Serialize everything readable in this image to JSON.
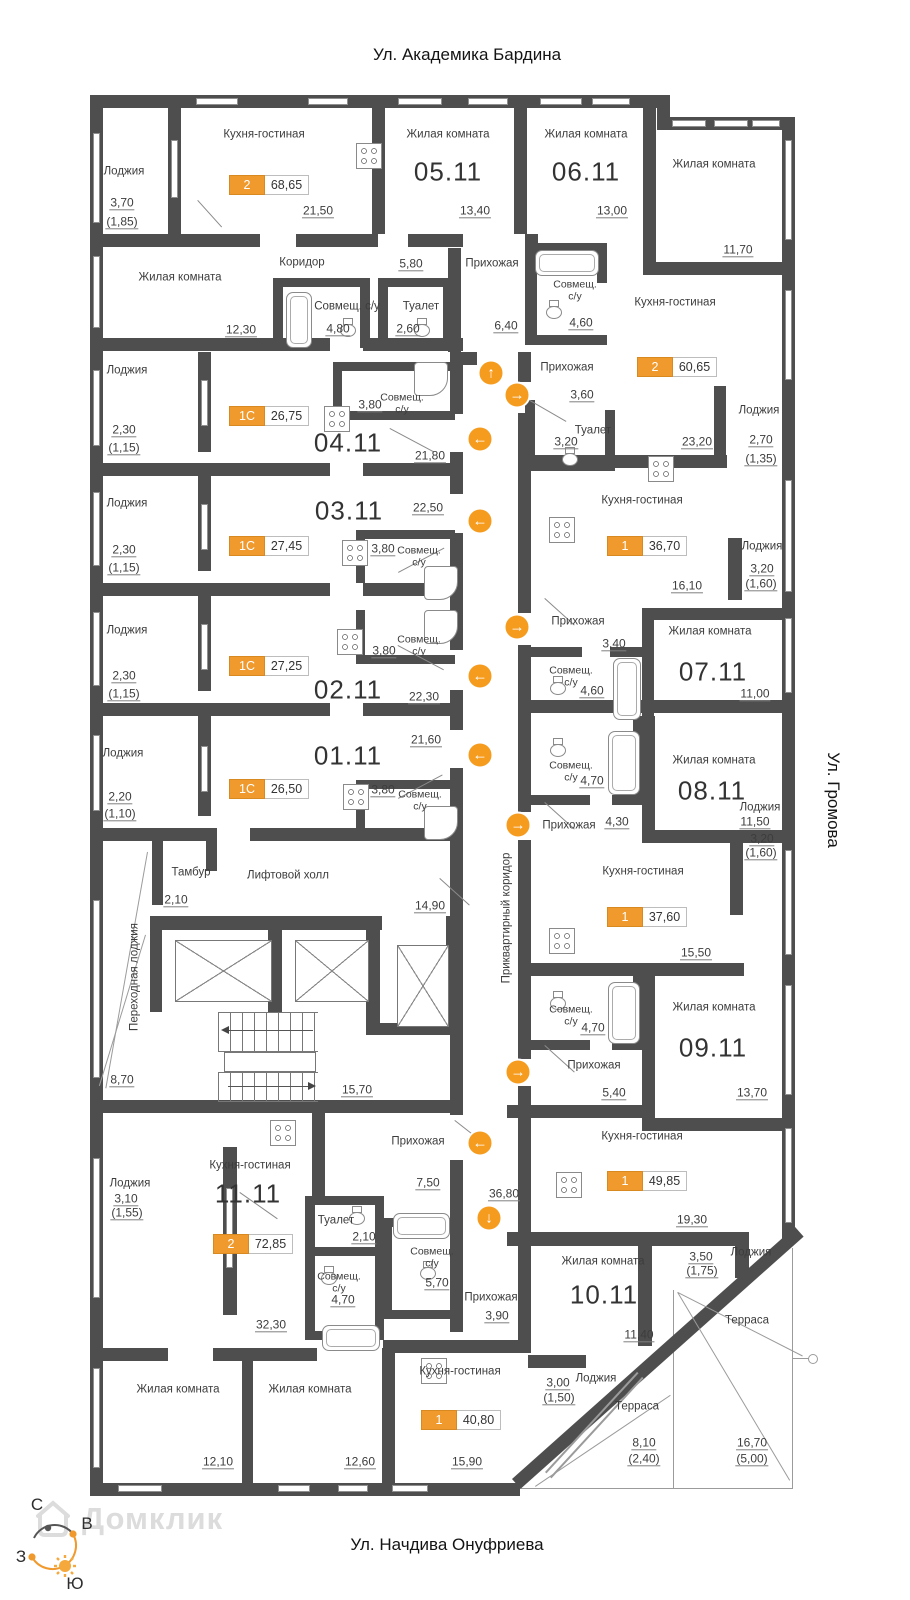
{
  "streets": {
    "top": "Ул. Академика Бардина",
    "right": "Ул. Громова",
    "bottom": "Ул. Начдива Онуфриева"
  },
  "compass": {
    "north": "С",
    "east": "В",
    "west": "З",
    "south": "Ю"
  },
  "watermark": {
    "brand": "Домклик"
  },
  "colors": {
    "wall": "#4E4E4E",
    "accent": "#F0992D",
    "arrow": "#F59B1E"
  },
  "plan": {
    "room_labels": [
      {
        "t": "Лоджия",
        "x": 124,
        "y": 172
      },
      {
        "t": "Кухня-гостиная",
        "x": 264,
        "y": 135
      },
      {
        "t": "Жилая комната",
        "x": 448,
        "y": 135
      },
      {
        "t": "Жилая комната",
        "x": 586,
        "y": 135
      },
      {
        "t": "Жилая комната",
        "x": 714,
        "y": 165
      },
      {
        "t": "Жилая комната",
        "x": 180,
        "y": 278
      },
      {
        "t": "Коридор",
        "x": 302,
        "y": 263
      },
      {
        "t": "Прихожая",
        "x": 492,
        "y": 264
      },
      {
        "t": "Совмещ. с/у",
        "x": 347,
        "y": 307
      },
      {
        "t": "Туалет",
        "x": 421,
        "y": 307
      },
      {
        "t": "Совмещ.\nс/у",
        "x": 575,
        "y": 291,
        "s": 10.5
      },
      {
        "t": "Кухня-гостиная",
        "x": 675,
        "y": 303
      },
      {
        "t": "Прихожая",
        "x": 567,
        "y": 368
      },
      {
        "t": "Туалет",
        "x": 593,
        "y": 431
      },
      {
        "t": "Лоджия",
        "x": 759,
        "y": 411
      },
      {
        "t": "Лоджия",
        "x": 127,
        "y": 371
      },
      {
        "t": "Совмещ.\nс/у",
        "x": 402,
        "y": 404,
        "s": 10.5
      },
      {
        "t": "Лоджия",
        "x": 127,
        "y": 504
      },
      {
        "t": "Совмещ.\nс/у",
        "x": 419,
        "y": 557,
        "s": 10.5
      },
      {
        "t": "Лоджия",
        "x": 127,
        "y": 631
      },
      {
        "t": "Совмещ.\nс/у",
        "x": 419,
        "y": 646,
        "s": 10.5
      },
      {
        "t": "Кухня-гостиная",
        "x": 642,
        "y": 501
      },
      {
        "t": "Лоджия",
        "x": 762,
        "y": 547
      },
      {
        "t": "Прихожая",
        "x": 578,
        "y": 622
      },
      {
        "t": "Совмещ.\nс/у",
        "x": 571,
        "y": 677,
        "s": 10.5
      },
      {
        "t": "Жилая комната",
        "x": 710,
        "y": 632
      },
      {
        "t": "Лоджия",
        "x": 123,
        "y": 754
      },
      {
        "t": "Совмещ.\nс/у",
        "x": 420,
        "y": 801,
        "s": 10.5
      },
      {
        "t": "Тамбур",
        "x": 191,
        "y": 873
      },
      {
        "t": "Лифтовой холл",
        "x": 288,
        "y": 876
      },
      {
        "t": "Совмещ.\nс/у",
        "x": 571,
        "y": 772,
        "s": 10.5
      },
      {
        "t": "Прихожая",
        "x": 569,
        "y": 826
      },
      {
        "t": "Жилая комната",
        "x": 714,
        "y": 761
      },
      {
        "t": "Кухня-гостиная",
        "x": 643,
        "y": 872
      },
      {
        "t": "Лоджия",
        "x": 760,
        "y": 808
      },
      {
        "t": "Переходная лоджия",
        "x": 135,
        "y": 977,
        "v": true
      },
      {
        "t": "Приквартирный коридор",
        "x": 507,
        "y": 918,
        "v": true
      },
      {
        "t": "Совмещ.\nс/у",
        "x": 571,
        "y": 1016,
        "s": 10.5
      },
      {
        "t": "Прихожая",
        "x": 594,
        "y": 1066
      },
      {
        "t": "Жилая комната",
        "x": 714,
        "y": 1008
      },
      {
        "t": "Кухня-гостиная",
        "x": 642,
        "y": 1137
      },
      {
        "t": "Прихожая",
        "x": 418,
        "y": 1142
      },
      {
        "t": "Кухня-гостиная",
        "x": 250,
        "y": 1166
      },
      {
        "t": "Лоджия",
        "x": 130,
        "y": 1184
      },
      {
        "t": "Туалет",
        "x": 336,
        "y": 1221
      },
      {
        "t": "Совмещ.\nс/у",
        "x": 432,
        "y": 1258,
        "s": 10.5
      },
      {
        "t": "Совмещ.\nс/у",
        "x": 339,
        "y": 1283,
        "s": 10.5
      },
      {
        "t": "Прихожая",
        "x": 491,
        "y": 1298
      },
      {
        "t": "Жилая комната",
        "x": 603,
        "y": 1262
      },
      {
        "t": "Лоджия",
        "x": 751,
        "y": 1253
      },
      {
        "t": "Терраса",
        "x": 747,
        "y": 1321
      },
      {
        "t": "Лоджия",
        "x": 596,
        "y": 1379
      },
      {
        "t": "Терраса",
        "x": 637,
        "y": 1407
      },
      {
        "t": "Жилая комната",
        "x": 178,
        "y": 1390
      },
      {
        "t": "Жилая комната",
        "x": 310,
        "y": 1390
      },
      {
        "t": "Кухня-гостиная",
        "x": 460,
        "y": 1372
      }
    ],
    "apartment_numbers": [
      {
        "t": "05.11",
        "x": 448,
        "y": 172
      },
      {
        "t": "06.11",
        "x": 586,
        "y": 172
      },
      {
        "t": "04.11",
        "x": 348,
        "y": 443
      },
      {
        "t": "03.11",
        "x": 349,
        "y": 511
      },
      {
        "t": "02.11",
        "x": 348,
        "y": 690
      },
      {
        "t": "01.11",
        "x": 348,
        "y": 756
      },
      {
        "t": "07.11",
        "x": 713,
        "y": 672
      },
      {
        "t": "08.11",
        "x": 712,
        "y": 791
      },
      {
        "t": "09.11",
        "x": 713,
        "y": 1048
      },
      {
        "t": "10.11",
        "x": 604,
        "y": 1295
      },
      {
        "t": "11.11",
        "x": 248,
        "y": 1194
      }
    ],
    "dimensions": [
      {
        "t": "3,70",
        "x": 122,
        "y": 203
      },
      {
        "t": "(1,85)",
        "x": 122,
        "y": 222
      },
      {
        "t": "21,50",
        "x": 318,
        "y": 211
      },
      {
        "t": "13,40",
        "x": 475,
        "y": 211
      },
      {
        "t": "13,00",
        "x": 612,
        "y": 211
      },
      {
        "t": "11,70",
        "x": 738,
        "y": 250
      },
      {
        "t": "12,30",
        "x": 241,
        "y": 330
      },
      {
        "t": "5,80",
        "x": 411,
        "y": 264
      },
      {
        "t": "4,80",
        "x": 338,
        "y": 329
      },
      {
        "t": "2,60",
        "x": 408,
        "y": 329
      },
      {
        "t": "6,40",
        "x": 506,
        "y": 326
      },
      {
        "t": "4,60",
        "x": 581,
        "y": 323
      },
      {
        "t": "3,60",
        "x": 582,
        "y": 395
      },
      {
        "t": "3,20",
        "x": 566,
        "y": 442
      },
      {
        "t": "23,20",
        "x": 697,
        "y": 442
      },
      {
        "t": "2,70",
        "x": 761,
        "y": 440
      },
      {
        "t": "(1,35)",
        "x": 761,
        "y": 459
      },
      {
        "t": "2,30",
        "x": 124,
        "y": 430
      },
      {
        "t": "(1,15)",
        "x": 124,
        "y": 448
      },
      {
        "t": "21,80",
        "x": 430,
        "y": 456
      },
      {
        "t": "3,80",
        "x": 370,
        "y": 405
      },
      {
        "t": "22,50",
        "x": 428,
        "y": 508
      },
      {
        "t": "3,80",
        "x": 383,
        "y": 549
      },
      {
        "t": "2,30",
        "x": 124,
        "y": 550
      },
      {
        "t": "(1,15)",
        "x": 124,
        "y": 568
      },
      {
        "t": "16,10",
        "x": 687,
        "y": 586
      },
      {
        "t": "3,20",
        "x": 762,
        "y": 569
      },
      {
        "t": "(1,60)",
        "x": 761,
        "y": 584
      },
      {
        "t": "3,40",
        "x": 614,
        "y": 644
      },
      {
        "t": "4,60",
        "x": 592,
        "y": 691
      },
      {
        "t": "11,00",
        "x": 755,
        "y": 694
      },
      {
        "t": "2,30",
        "x": 124,
        "y": 676
      },
      {
        "t": "(1,15)",
        "x": 124,
        "y": 694
      },
      {
        "t": "3,80",
        "x": 384,
        "y": 651
      },
      {
        "t": "22,30",
        "x": 424,
        "y": 697
      },
      {
        "t": "21,60",
        "x": 426,
        "y": 740
      },
      {
        "t": "2,20",
        "x": 120,
        "y": 797
      },
      {
        "t": "(1,10)",
        "x": 120,
        "y": 814
      },
      {
        "t": "3,80",
        "x": 383,
        "y": 790
      },
      {
        "t": "4,70",
        "x": 592,
        "y": 781
      },
      {
        "t": "4,30",
        "x": 617,
        "y": 822
      },
      {
        "t": "11,50",
        "x": 755,
        "y": 822
      },
      {
        "t": "15,50",
        "x": 696,
        "y": 953
      },
      {
        "t": "3,20",
        "x": 762,
        "y": 839
      },
      {
        "t": "(1,60)",
        "x": 761,
        "y": 853
      },
      {
        "t": "2,10",
        "x": 176,
        "y": 900
      },
      {
        "t": "14,90",
        "x": 430,
        "y": 906
      },
      {
        "t": "8,70",
        "x": 122,
        "y": 1080
      },
      {
        "t": "15,70",
        "x": 357,
        "y": 1090
      },
      {
        "t": "4,70",
        "x": 593,
        "y": 1028
      },
      {
        "t": "5,40",
        "x": 614,
        "y": 1093
      },
      {
        "t": "13,70",
        "x": 752,
        "y": 1093
      },
      {
        "t": "7,50",
        "x": 428,
        "y": 1183
      },
      {
        "t": "36,80",
        "x": 504,
        "y": 1194
      },
      {
        "t": "3,10",
        "x": 126,
        "y": 1199
      },
      {
        "t": "(1,55)",
        "x": 127,
        "y": 1213
      },
      {
        "t": "2,10",
        "x": 364,
        "y": 1237
      },
      {
        "t": "4,70",
        "x": 343,
        "y": 1300
      },
      {
        "t": "5,70",
        "x": 437,
        "y": 1283
      },
      {
        "t": "3,90",
        "x": 497,
        "y": 1316
      },
      {
        "t": "32,30",
        "x": 271,
        "y": 1325
      },
      {
        "t": "19,30",
        "x": 692,
        "y": 1220
      },
      {
        "t": "11,40",
        "x": 639,
        "y": 1335
      },
      {
        "t": "3,50",
        "x": 701,
        "y": 1257
      },
      {
        "t": "(1,75)",
        "x": 702,
        "y": 1271
      },
      {
        "t": "3,00",
        "x": 558,
        "y": 1383
      },
      {
        "t": "(1,50)",
        "x": 559,
        "y": 1398
      },
      {
        "t": "8,10",
        "x": 644,
        "y": 1443
      },
      {
        "t": "(2,40)",
        "x": 644,
        "y": 1459
      },
      {
        "t": "16,70",
        "x": 752,
        "y": 1443
      },
      {
        "t": "(5,00)",
        "x": 752,
        "y": 1459
      },
      {
        "t": "12,10",
        "x": 218,
        "y": 1462
      },
      {
        "t": "12,60",
        "x": 360,
        "y": 1462
      },
      {
        "t": "15,90",
        "x": 467,
        "y": 1462
      }
    ],
    "unit_badges": [
      {
        "type": "2",
        "area": "68,65",
        "x": 229,
        "y": 175
      },
      {
        "type": "2",
        "area": "60,65",
        "x": 637,
        "y": 357
      },
      {
        "type": "1С",
        "area": "26,75",
        "x": 229,
        "y": 406
      },
      {
        "type": "1С",
        "area": "27,45",
        "x": 229,
        "y": 536
      },
      {
        "type": "1С",
        "area": "27,25",
        "x": 229,
        "y": 656
      },
      {
        "type": "1С",
        "area": "26,50",
        "x": 229,
        "y": 779
      },
      {
        "type": "1",
        "area": "36,70",
        "x": 607,
        "y": 536
      },
      {
        "type": "1",
        "area": "37,60",
        "x": 607,
        "y": 907
      },
      {
        "type": "1",
        "area": "49,85",
        "x": 607,
        "y": 1171
      },
      {
        "type": "2",
        "area": "72,85",
        "x": 213,
        "y": 1234
      },
      {
        "type": "1",
        "area": "40,80",
        "x": 421,
        "y": 1410
      }
    ],
    "arrows": [
      {
        "dir": "up",
        "x": 491,
        "y": 373
      },
      {
        "dir": "right",
        "x": 517,
        "y": 395
      },
      {
        "dir": "left",
        "x": 480,
        "y": 439
      },
      {
        "dir": "left",
        "x": 480,
        "y": 521
      },
      {
        "dir": "right",
        "x": 517,
        "y": 627
      },
      {
        "dir": "left",
        "x": 480,
        "y": 676
      },
      {
        "dir": "left",
        "x": 480,
        "y": 755
      },
      {
        "dir": "right",
        "x": 518,
        "y": 825
      },
      {
        "dir": "right",
        "x": 518,
        "y": 1072
      },
      {
        "dir": "left",
        "x": 480,
        "y": 1143
      },
      {
        "dir": "down",
        "x": 489,
        "y": 1218
      }
    ]
  }
}
